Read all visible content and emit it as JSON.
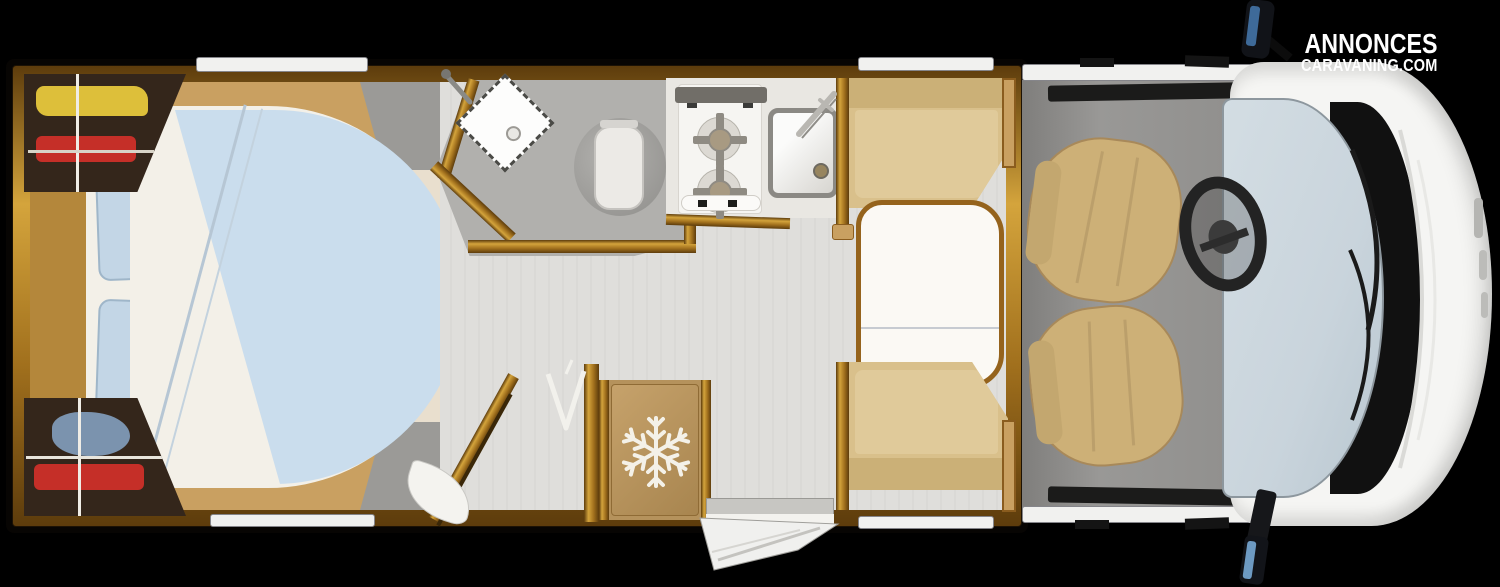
{
  "brand": {
    "line1": "ANNONCES",
    "line2": "CARAVANING.COM"
  },
  "icons": {
    "snowflake-icon": "❄ (freezer symbol on fridge door)",
    "hanger-icon": "V-shaped wall hook near shower",
    "basin-faucet-icon": "chrome faucet on bathroom washbasin",
    "sink-faucet-icon": "chrome faucet on kitchen sink"
  },
  "palette": {
    "page_bg": "#000000",
    "wood_gold": "#a1701d",
    "wood_gold_light": "#d4a43c",
    "wood_dark": "#5d3c0c",
    "wood_panel": "#c9a061",
    "bedroom_floor": "#e9dfce",
    "bed_sheet": "#f3f0e8",
    "bed_duvet": "#cadded",
    "pillow": "#c3d6e6",
    "wardrobe_interior": "#34261b",
    "clothes_yellow": "#ddbf3a",
    "clothes_red": "#c52f28",
    "clothes_blue": "#7b93ae",
    "floor_main": "#dfdedb",
    "floor_bathroom": "#b1b0ad",
    "porcelain": "#f6f5f2",
    "counter": "#e9e7e2",
    "seat_cushion": "#d9c08b",
    "seat_cushion_light": "#e0ca9a",
    "table_top": "#fbf9f4",
    "fridge_wood": "#b5925c",
    "cab_floor": "#908f8d",
    "cab_seat": "#cdb077",
    "vehicle_white": "#f5f5f3",
    "windshield": "#c9d4dc",
    "detail_black": "#111111",
    "mirror_glass": "#3e6a99",
    "brand_text": "#ffffff"
  }
}
